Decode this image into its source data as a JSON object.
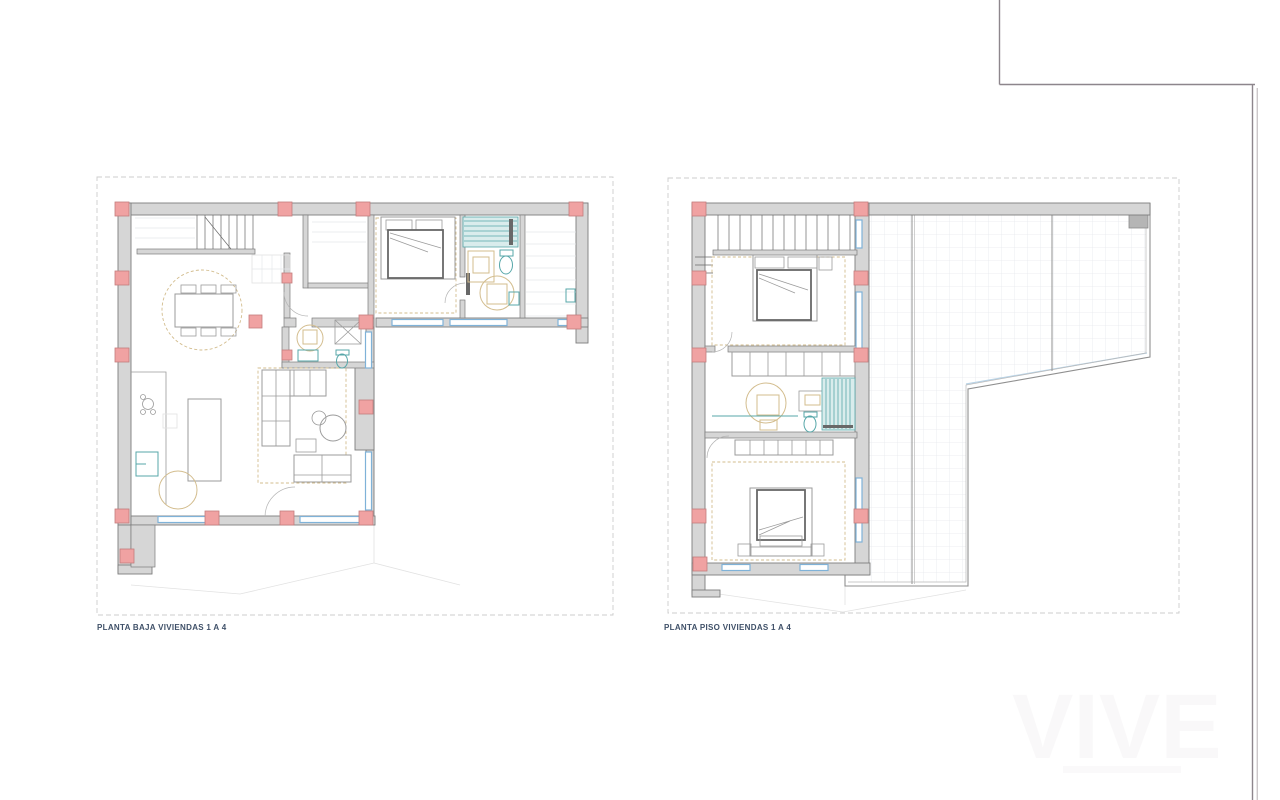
{
  "document": {
    "captions": {
      "left": "PLANTA BAJA VIVIENDAS 1 A 4",
      "right": "PLANTA PISO VIVIENDAS 1 A 4"
    },
    "watermark": "VIVE"
  },
  "colors": {
    "paper": "#ffffff",
    "wall": "#d6d6d6",
    "wall-stroke": "#7d7d7d",
    "column": "#f0a2a2",
    "column-stroke": "#c47d7d",
    "window": "#7fb2d8",
    "window-light": "#b9d3e6",
    "fixture": "#57a7a9",
    "shower-fill": "#d9ecec",
    "furniture": "#9b9b9b",
    "furniture-dark": "#686868",
    "rug": "#d3bd8e",
    "tile-grid": "#e5e8ea",
    "boundary": "#cccccc",
    "faint": "#e2e2e2",
    "caption": "#3f5068",
    "frame-line": "#8d868c",
    "chimney": "#b5b5b5"
  }
}
